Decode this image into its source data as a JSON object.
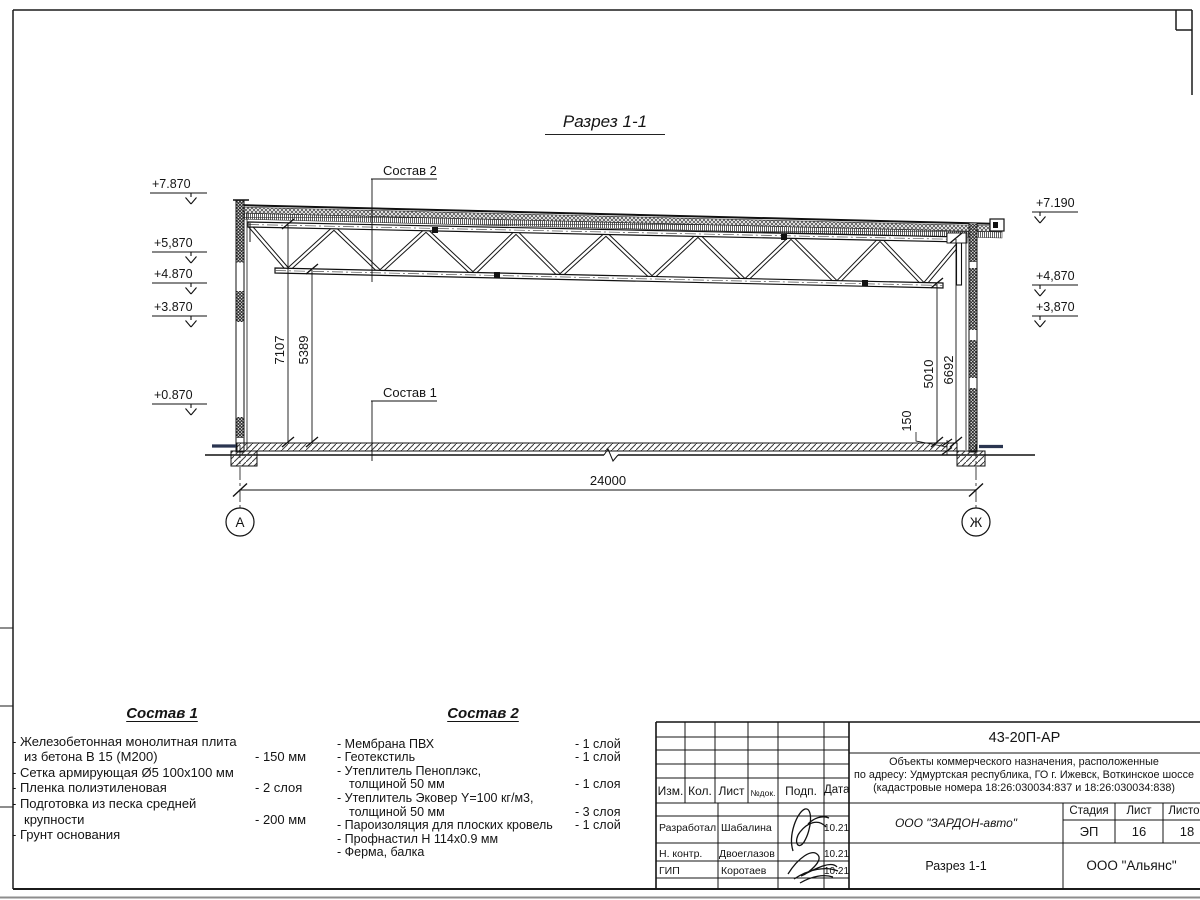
{
  "sheet": {
    "title": "Разрез 1-1"
  },
  "section": {
    "label_sostav1": "Состав 1",
    "label_sostav2": "Состав 2",
    "elev_left": [
      "+7.870",
      "+5,870",
      "+4.870",
      "+3.870",
      "+0.870"
    ],
    "elev_right": [
      "+7.190",
      "+4,870",
      "+3,870"
    ],
    "dim_span": "24000",
    "dim_h_left": [
      "7107",
      "5389"
    ],
    "dim_h_right": [
      "5010",
      "6692"
    ],
    "dim_slab": "150",
    "axis_left": "А",
    "axis_right": "Ж"
  },
  "sostav1": {
    "heading": "Состав 1",
    "rows": [
      {
        "t": "- Железобетонная  монолитная плита",
        "v": ""
      },
      {
        "t": "из бетона В 15 (М200)",
        "v": "- 150 мм"
      },
      {
        "t": "- Сетка армирующая Ø5 100х100 мм",
        "v": ""
      },
      {
        "t": "- Пленка полиэтиленовая",
        "v": "-  2 слоя"
      },
      {
        "t": "- Подготовка из песка средней",
        "v": ""
      },
      {
        "t": "крупности",
        "v": "- 200 мм"
      },
      {
        "t": "- Грунт основания",
        "v": ""
      }
    ]
  },
  "sostav2": {
    "heading": "Состав 2",
    "rows": [
      {
        "t": "- Мембрана ПВХ",
        "v": "- 1 слой"
      },
      {
        "t": "- Геотекстиль",
        "v": "- 1 слой"
      },
      {
        "t": "- Утеплитель Пеноплэкс,",
        "v": ""
      },
      {
        "t": "толщиной 50 мм",
        "v": "- 1 слоя"
      },
      {
        "t": "- Утеплитель Эковер Y=100 кг/м3,",
        "v": ""
      },
      {
        "t": "толщиной 50 мм",
        "v": "- 3 слоя"
      },
      {
        "t": "- Пароизоляция для плоских кровель",
        "v": "- 1 слой"
      },
      {
        "t": "- Профнастил Н 114х0.9 мм",
        "v": ""
      },
      {
        "t": "- Ферма, балка",
        "v": ""
      }
    ]
  },
  "stamp": {
    "doc_number": "43-20П-АР",
    "project_line1": "Объекты коммерческого назначения, расположенные",
    "project_line2": "по адресу: Удмуртская республика, ГО г. Ижевск, Воткинское шоссе",
    "project_line3": "(кадастровые номера 18:26:030034:837 и 18:26:030034:838)",
    "cols": {
      "izm": "Изм.",
      "kol": "Кол.",
      "list": "Лист",
      "ndok": "№док.",
      "podp": "Подп.",
      "data": "Дата"
    },
    "rows": [
      {
        "role": "Разработал",
        "name": "Шабалина",
        "date": "10.21"
      },
      {
        "role": "Н. контр.",
        "name": "Двоеглазов",
        "date": "10.21"
      },
      {
        "role": "ГИП",
        "name": "Коротаев",
        "date": "10.21"
      }
    ],
    "org": "ООО \"ЗАРДОН-авто\"",
    "stage_label": "Стадия",
    "sheet_label": "Лист",
    "sheets_label": "Листов",
    "stage": "ЭП",
    "sheet_no": "16",
    "sheets_total": "18",
    "drawing_name": "Разрез 1-1",
    "company": "ООО \"Альянс\""
  }
}
